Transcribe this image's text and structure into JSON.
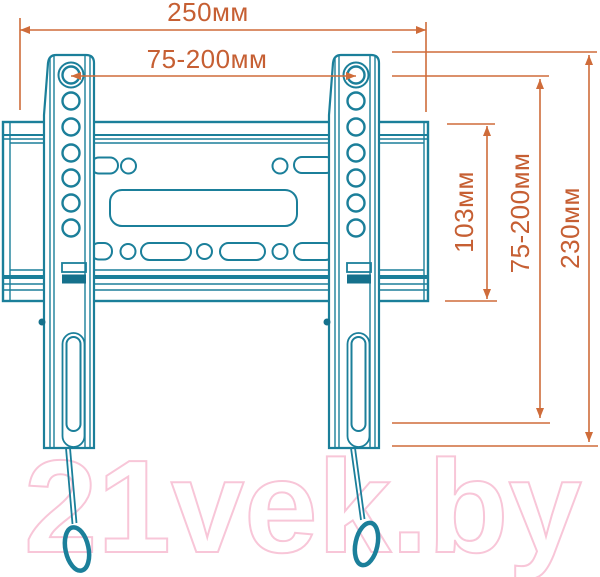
{
  "title": "TV wall mount bracket dimension diagram",
  "watermark": {
    "text": "21vek.by"
  },
  "colors": {
    "drawing_teal": "#1b7f9a",
    "dimension_orange": "#cf6c3a",
    "watermark_pink": "#f8c6d8",
    "background": "#ffffff"
  },
  "dimensions": {
    "overall_width": {
      "label": "250мм",
      "orientation": "horizontal",
      "measures": "wall plate overall width"
    },
    "horizontal_hole_spacing": {
      "label": "75-200мм",
      "orientation": "horizontal",
      "measures": "VESA horizontal hole spacing"
    },
    "plate_height": {
      "label": "103мм",
      "orientation": "vertical",
      "measures": "wall plate height"
    },
    "vertical_hole_spacing": {
      "label": "75-200мм",
      "orientation": "vertical",
      "measures": "VESA vertical hole spacing"
    },
    "bracket_height": {
      "label": "230мм",
      "orientation": "vertical",
      "measures": "bracket arm overall height"
    }
  }
}
